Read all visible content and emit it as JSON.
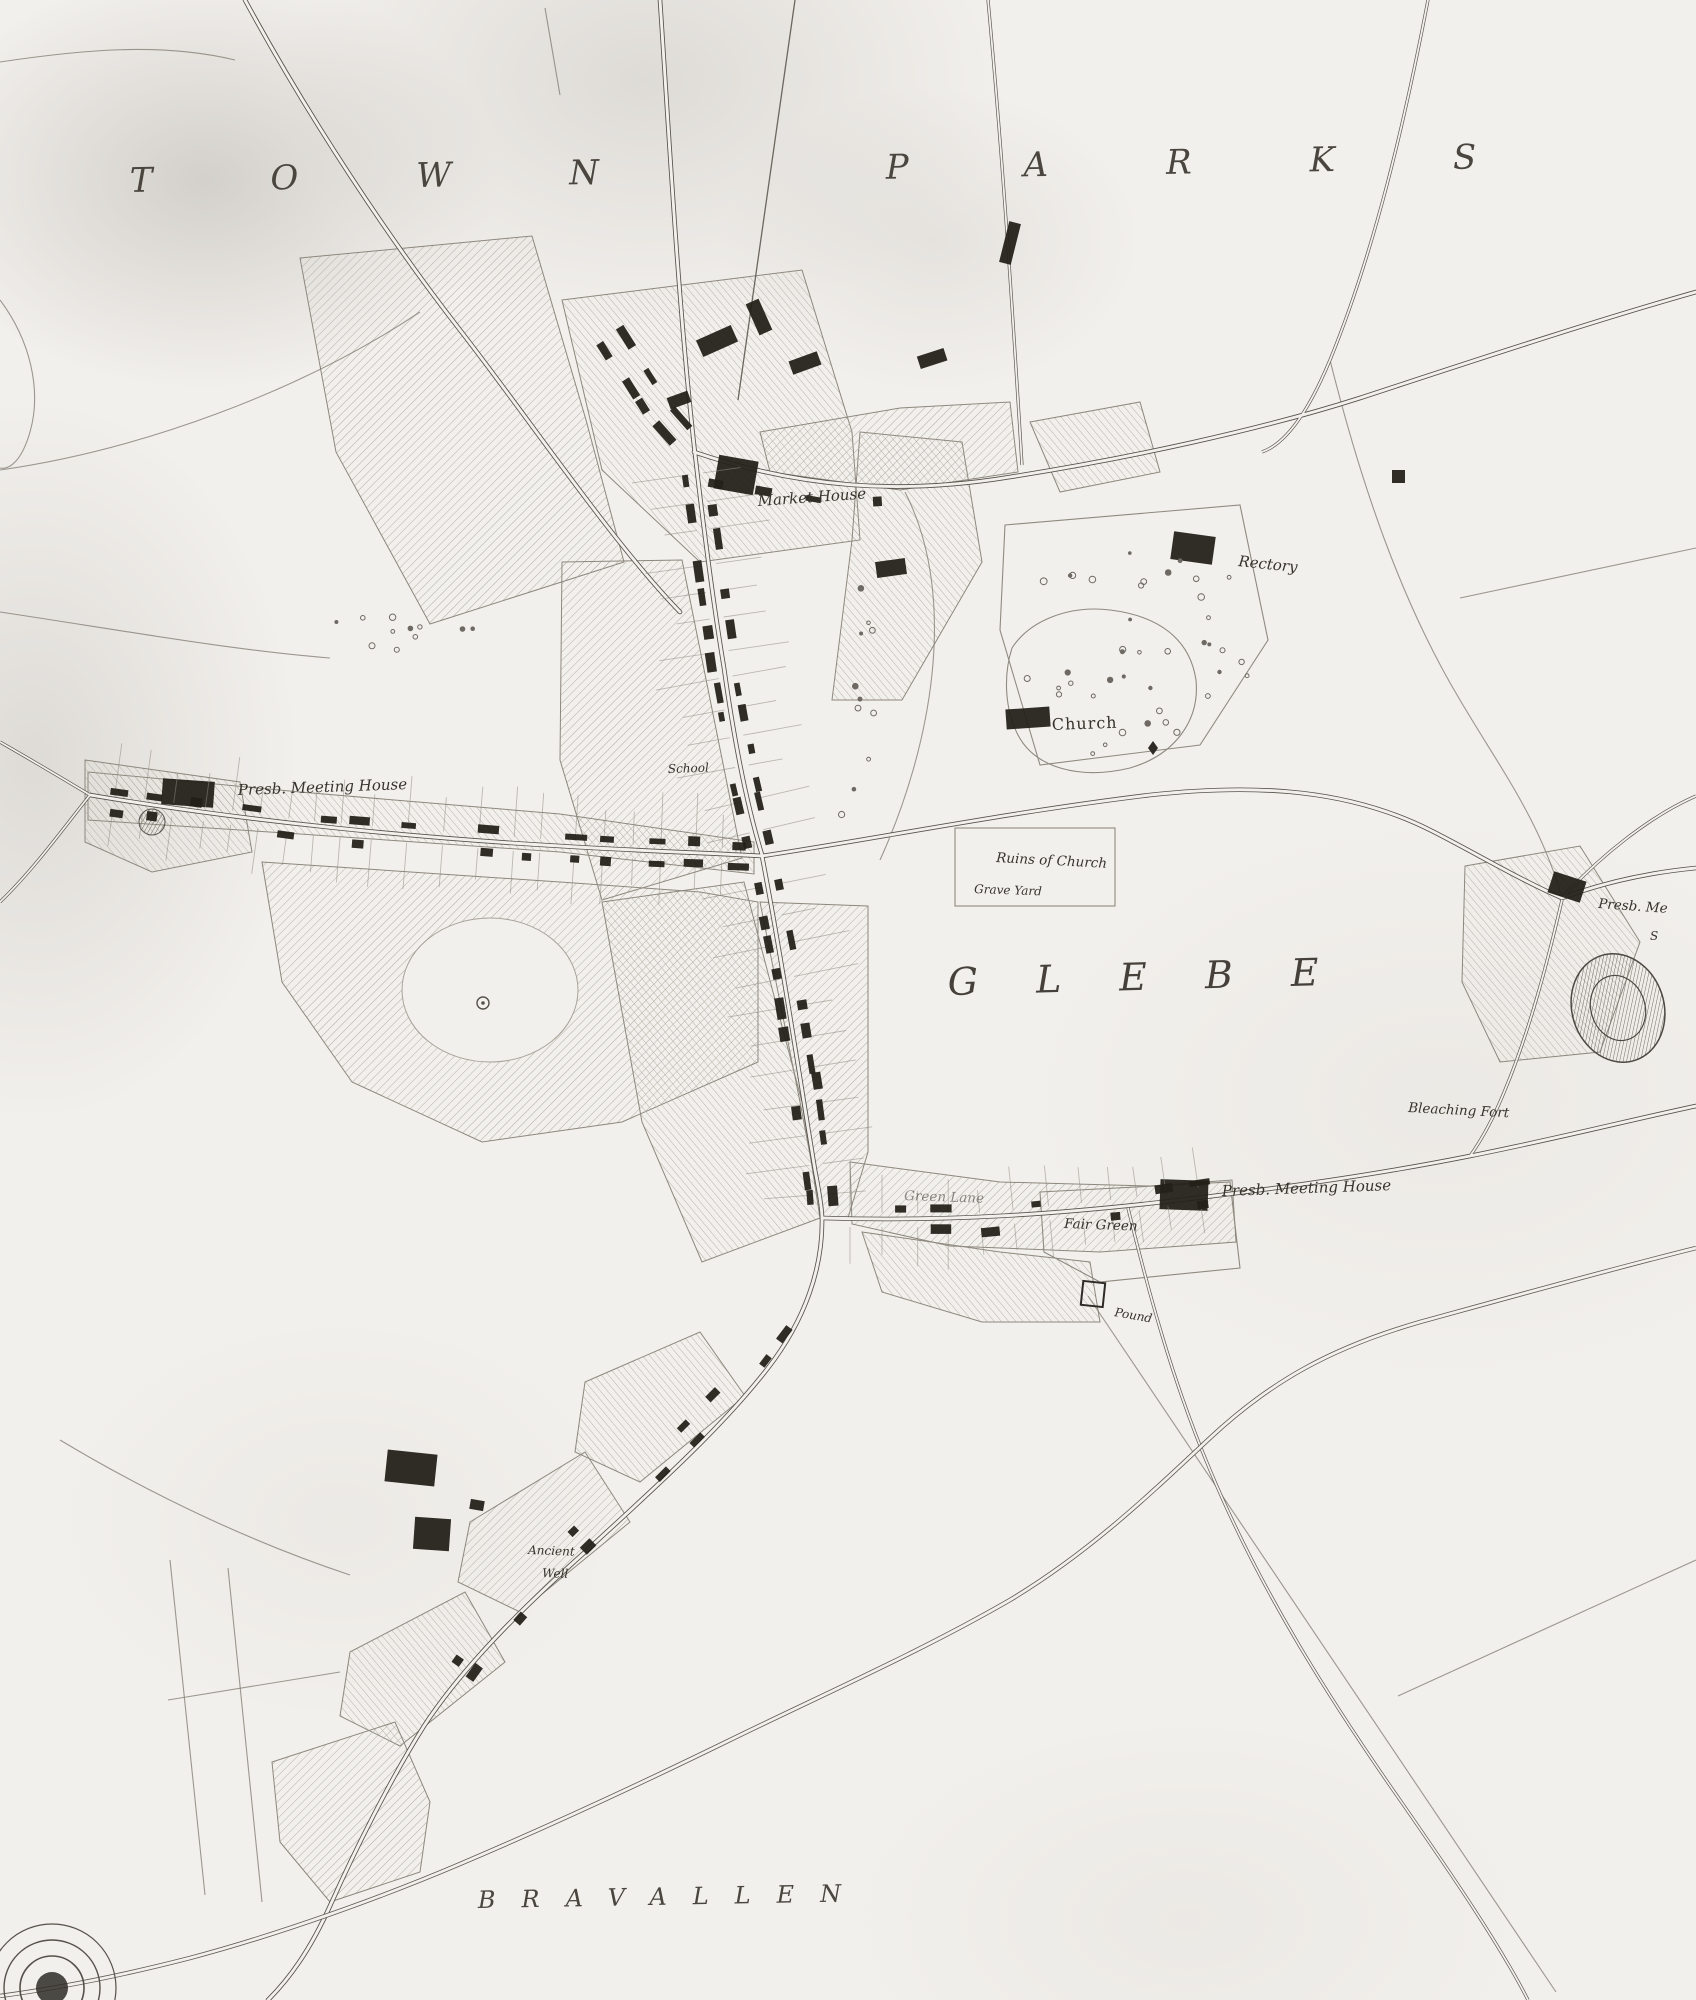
{
  "map": {
    "type": "historic-town-plan-scan",
    "colors": {
      "paper": "#f2f0ec",
      "ink": "#2b2824",
      "hatch": "#a9a49b",
      "road_casing": "#55514a"
    },
    "labels": [
      {
        "id": "townland-town-parks",
        "text": "TOWN PARKS",
        "x": 130,
        "y": 192,
        "rot": -1,
        "cls": "lbl-xl"
      },
      {
        "id": "townland-glebe",
        "text": "GLEBE",
        "x": 948,
        "y": 995,
        "rot": -1.5,
        "cls": "lbl-lg"
      },
      {
        "id": "townland-bravallen",
        "text": "BRAVALLEN",
        "x": 478,
        "y": 1908,
        "rot": -1,
        "cls": "lbl-md"
      },
      {
        "id": "market-house",
        "text": "Market House",
        "x": 758,
        "y": 506,
        "rot": -4,
        "cls": "lbl"
      },
      {
        "id": "rectory",
        "text": "Rectory",
        "x": 1238,
        "y": 566,
        "rot": 6,
        "cls": "lbl"
      },
      {
        "id": "church",
        "text": "Church",
        "x": 1052,
        "y": 730,
        "rot": -2,
        "cls": "lbl-up"
      },
      {
        "id": "ruins-of-church",
        "text": "Ruins of Church",
        "x": 996,
        "y": 862,
        "rot": 3,
        "cls": "lbl-13"
      },
      {
        "id": "grave-yard",
        "text": "Grave Yard",
        "x": 974,
        "y": 893,
        "rot": 2,
        "cls": "lbl-sm"
      },
      {
        "id": "presb-meeting-house-west",
        "text": "Presb. Meeting House",
        "x": 238,
        "y": 795,
        "rot": -2,
        "cls": "lbl"
      },
      {
        "id": "presb-meeting-house-se",
        "text": "Presb. Meeting House",
        "x": 1222,
        "y": 1196,
        "rot": -2,
        "cls": "lbl"
      },
      {
        "id": "presb-meeting-house-east",
        "text": "Presb. Me",
        "x": 1598,
        "y": 908,
        "rot": 4,
        "cls": "lbl-13"
      },
      {
        "id": "east-edge-fragment",
        "text": "S",
        "x": 1650,
        "y": 940,
        "rot": 0,
        "cls": "lbl-sm"
      },
      {
        "id": "fair-green",
        "text": "Fair Green",
        "x": 1064,
        "y": 1228,
        "rot": 2,
        "cls": "lbl-13"
      },
      {
        "id": "green-lane",
        "text": "Green Lane",
        "x": 904,
        "y": 1200,
        "rot": 2,
        "cls": "lbl-13 lbl-faint"
      },
      {
        "id": "pound",
        "text": "Pound",
        "x": 1114,
        "y": 1316,
        "rot": 10,
        "cls": "lbl-sm"
      },
      {
        "id": "bleaching-fort",
        "text": "Bleaching Fort",
        "x": 1408,
        "y": 1112,
        "rot": 3,
        "cls": "lbl-13"
      },
      {
        "id": "ancient-well-line1",
        "text": "Ancient",
        "x": 528,
        "y": 1554,
        "rot": 2,
        "cls": "lbl-sm"
      },
      {
        "id": "ancient-well-line2",
        "text": "Well",
        "x": 542,
        "y": 1577,
        "rot": 2,
        "cls": "lbl-sm"
      },
      {
        "id": "school",
        "text": "School",
        "x": 668,
        "y": 773,
        "rot": -2,
        "cls": "lbl-sm"
      }
    ]
  }
}
